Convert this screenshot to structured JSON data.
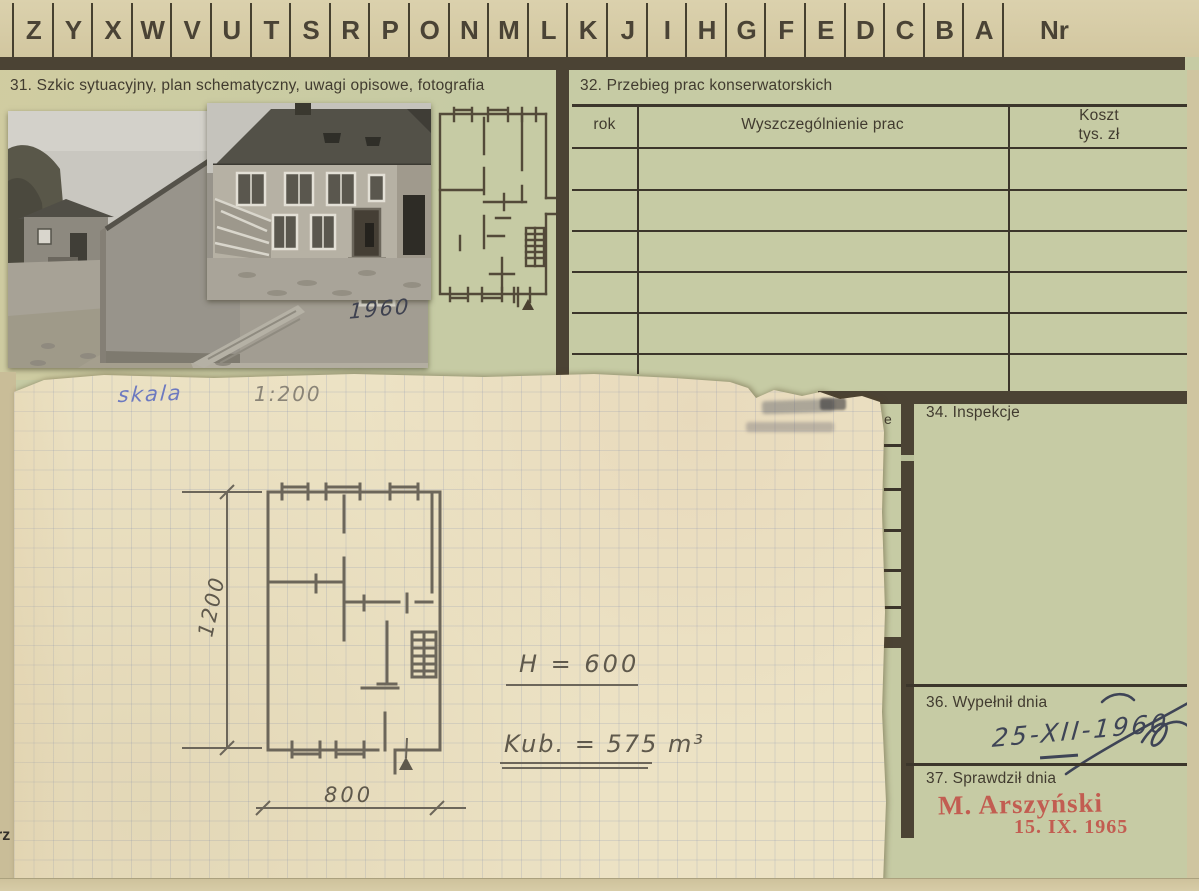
{
  "card": {
    "index_row": {
      "letters": [
        "Z",
        "Y",
        "X",
        "W",
        "V",
        "U",
        "T",
        "S",
        "R",
        "P",
        "O",
        "N",
        "M",
        "L",
        "K",
        "J",
        "I",
        "H",
        "G",
        "F",
        "E",
        "D",
        "C",
        "B",
        "A"
      ],
      "number_label": "Nr"
    },
    "section31": {
      "title": "31. Szkic sytuacyjny, plan schematyczny, uwagi opisowe, fotografia",
      "photo_caption_year": "1960"
    },
    "section32": {
      "title": "32. Przebieg prac konserwatorskich",
      "table": {
        "col_year": "rok",
        "col_works": "Wyszczególnienie prac",
        "col_cost_line1": "Koszt",
        "col_cost_line2": "tys. zł",
        "visible_empty_rows": 6
      }
    },
    "section33_fragment": {
      "visible_text": "e"
    },
    "section34": {
      "title": "34. Inspekcje"
    },
    "section36": {
      "title": "36. Wypełnił dnia",
      "handwritten_date": "25-XII-1960"
    },
    "section37": {
      "title": "37. Sprawdził dnia",
      "stamp_name": "M. Arszyński",
      "stamp_date": "15. IX. 1965"
    },
    "corner_fragment": "rz"
  },
  "sketch_sheet": {
    "scale_word": "skala",
    "scale_value": "1:200",
    "height_note": "H = 600",
    "volume_note": "Kub. = 575 m³",
    "dim_height": "1200",
    "dim_width": "800"
  },
  "colors": {
    "card_green": "#c6cba4",
    "tab_tan": "#d5caa5",
    "ink_dark": "#46402f",
    "stamp_red": "#c2544a",
    "hand_blue": "#6d79c0",
    "pencil_gray": "#6a6457",
    "ink_date_blue": "#3e4456"
  }
}
